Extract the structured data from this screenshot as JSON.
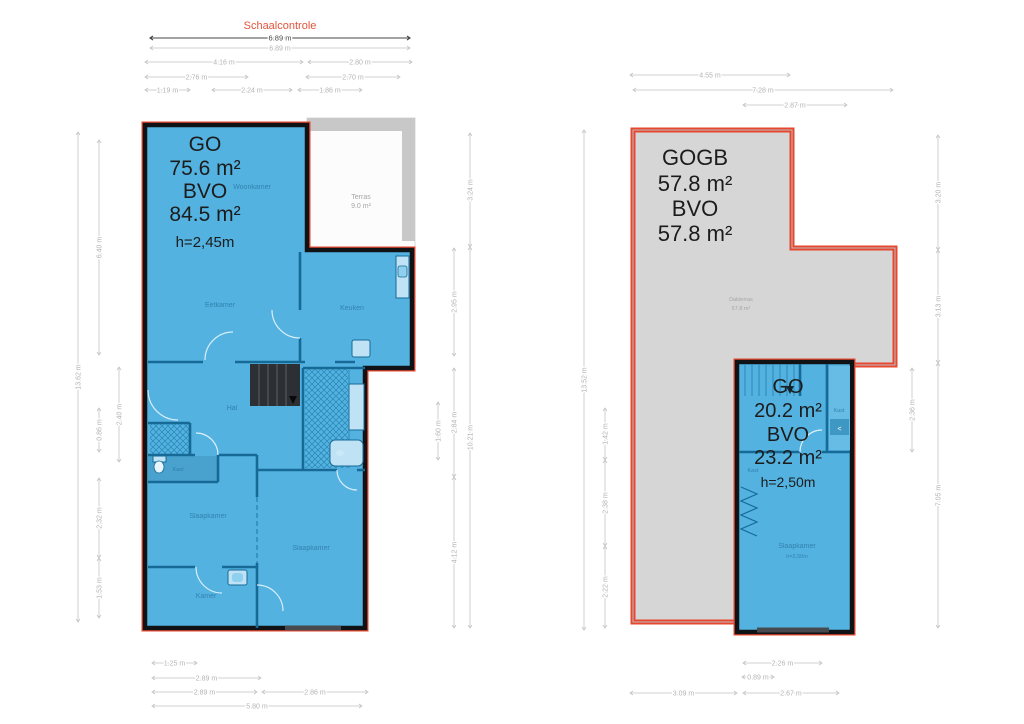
{
  "scale_control": {
    "title": "Schaalcontrole"
  },
  "colors": {
    "unit_fill": "#53b2e0",
    "outer_wall": "#101316",
    "interior_wall": "#176a96",
    "outline_red": "#e8472f",
    "roof_gray": "#d6d6d6",
    "terrace_band_gray": "#c8c8c8",
    "dimension_gray": "#b3b3b3",
    "scale_title_red": "#e2543b",
    "overlay_text": "#1c1c1c"
  },
  "left_plan": {
    "overlay": {
      "line1": "GO",
      "line2": "75.6 m²",
      "line3": "BVO",
      "line4": "84.5 m²",
      "line5": "h=2,45m"
    },
    "rooms": {
      "woonkamer": "Woonkamer",
      "eetkamer": "Eetkamer",
      "keuken": "Keuken",
      "hal": "Hal",
      "kast": "Kast",
      "slaapkamer_left": "Slaapkamer",
      "slaapkamer_right": "Slaapkamer",
      "kamer": "Kamer",
      "terras_name": "Terras",
      "terras_area": "9.0 m²"
    },
    "dimensions": [
      {
        "label": "6.89 m",
        "o": "h",
        "a": 150,
        "b": 410,
        "c": 38,
        "dark": true
      },
      {
        "label": "6.89 m",
        "o": "h",
        "a": 150,
        "b": 410,
        "c": 48
      },
      {
        "label": "4.16 m",
        "o": "h",
        "a": 145,
        "b": 303,
        "c": 62
      },
      {
        "label": "2.80 m",
        "o": "h",
        "a": 308,
        "b": 412,
        "c": 62
      },
      {
        "label": "2.76 m",
        "o": "h",
        "a": 145,
        "b": 248,
        "c": 77
      },
      {
        "label": "2.70 m",
        "o": "h",
        "a": 306,
        "b": 400,
        "c": 77
      },
      {
        "label": "1.19 m",
        "o": "h",
        "a": 145,
        "b": 190,
        "c": 90
      },
      {
        "label": "2.24 m",
        "o": "h",
        "a": 212,
        "b": 292,
        "c": 90
      },
      {
        "label": "1.86 m",
        "o": "h",
        "a": 298,
        "b": 362,
        "c": 90
      },
      {
        "label": "13.62 m",
        "o": "v",
        "a": 132,
        "b": 622,
        "c": 78
      },
      {
        "label": "6.40 m",
        "o": "v",
        "a": 140,
        "b": 355,
        "c": 99
      },
      {
        "label": "0.86 m",
        "o": "v",
        "a": 408,
        "b": 452,
        "c": 99
      },
      {
        "label": "2.32 m",
        "o": "v",
        "a": 478,
        "b": 558,
        "c": 99
      },
      {
        "label": "1.53 m",
        "o": "v",
        "a": 558,
        "b": 618,
        "c": 99
      },
      {
        "label": "2.40 m",
        "o": "v",
        "a": 367,
        "b": 462,
        "c": 119
      },
      {
        "label": "1.60 m",
        "o": "v",
        "a": 402,
        "b": 460,
        "c": 438
      },
      {
        "label": "2.95 m",
        "o": "v",
        "a": 248,
        "b": 356,
        "c": 454
      },
      {
        "label": "2.84 m",
        "o": "v",
        "a": 368,
        "b": 477,
        "c": 454
      },
      {
        "label": "4.12 m",
        "o": "v",
        "a": 477,
        "b": 628,
        "c": 454
      },
      {
        "label": "3.24 m",
        "o": "v",
        "a": 133,
        "b": 247,
        "c": 470
      },
      {
        "label": "10.21 m",
        "o": "v",
        "a": 247,
        "b": 628,
        "c": 470
      },
      {
        "label": "1.25 m",
        "o": "h",
        "a": 152,
        "b": 197,
        "c": 663
      },
      {
        "label": "2.89 m",
        "o": "h",
        "a": 152,
        "b": 261,
        "c": 678
      },
      {
        "label": "2.89 m",
        "o": "h",
        "a": 152,
        "b": 257,
        "c": 692
      },
      {
        "label": "2.86 m",
        "o": "h",
        "a": 262,
        "b": 368,
        "c": 692
      },
      {
        "label": "5.80 m",
        "o": "h",
        "a": 152,
        "b": 362,
        "c": 706
      }
    ]
  },
  "right_plan": {
    "roof_overlay": {
      "line1": "GOGB",
      "line2": "57.8 m²",
      "line3": "BVO",
      "line4": "57.8 m²"
    },
    "roof_label": {
      "name": "Dakterras",
      "area": "57.8 m²"
    },
    "unit_overlay": {
      "line1": "GO",
      "line2": "20.2 m²",
      "line3": "BVO",
      "line4": "23.2 m²",
      "line5": "h=2,50m"
    },
    "rooms": {
      "slaapkamer": "Slaapkamer",
      "slaapkamer_h": "h=2,50m",
      "kast_right": "Kast",
      "kast_left": "Kast",
      "shelf_icon": "<"
    },
    "dimensions": [
      {
        "label": "4.55 m",
        "o": "h",
        "a": 630,
        "b": 790,
        "c": 75
      },
      {
        "label": "7.28 m",
        "o": "h",
        "a": 633,
        "b": 893,
        "c": 90
      },
      {
        "label": "2.87 m",
        "o": "h",
        "a": 743,
        "b": 847,
        "c": 105
      },
      {
        "label": "13.52 m",
        "o": "v",
        "a": 130,
        "b": 630,
        "c": 584
      },
      {
        "label": "1.42 m",
        "o": "v",
        "a": 408,
        "b": 460,
        "c": 605
      },
      {
        "label": "2.38 m",
        "o": "v",
        "a": 460,
        "b": 546,
        "c": 605
      },
      {
        "label": "2.22 m",
        "o": "v",
        "a": 546,
        "b": 628,
        "c": 605
      },
      {
        "label": "3.20 m",
        "o": "v",
        "a": 135,
        "b": 250,
        "c": 938
      },
      {
        "label": "3.13 m",
        "o": "v",
        "a": 250,
        "b": 363,
        "c": 938
      },
      {
        "label": "7.05 m",
        "o": "v",
        "a": 363,
        "b": 628,
        "c": 938
      },
      {
        "label": "2.36 m",
        "o": "v",
        "a": 368,
        "b": 452,
        "c": 912
      },
      {
        "label": "2.26 m",
        "o": "h",
        "a": 743,
        "b": 822,
        "c": 663
      },
      {
        "label": "0.89 m",
        "o": "h",
        "a": 742,
        "b": 774,
        "c": 677
      },
      {
        "label": "3.09 m",
        "o": "h",
        "a": 630,
        "b": 737,
        "c": 693
      },
      {
        "label": "2.67 m",
        "o": "h",
        "a": 743,
        "b": 839,
        "c": 693
      }
    ]
  }
}
